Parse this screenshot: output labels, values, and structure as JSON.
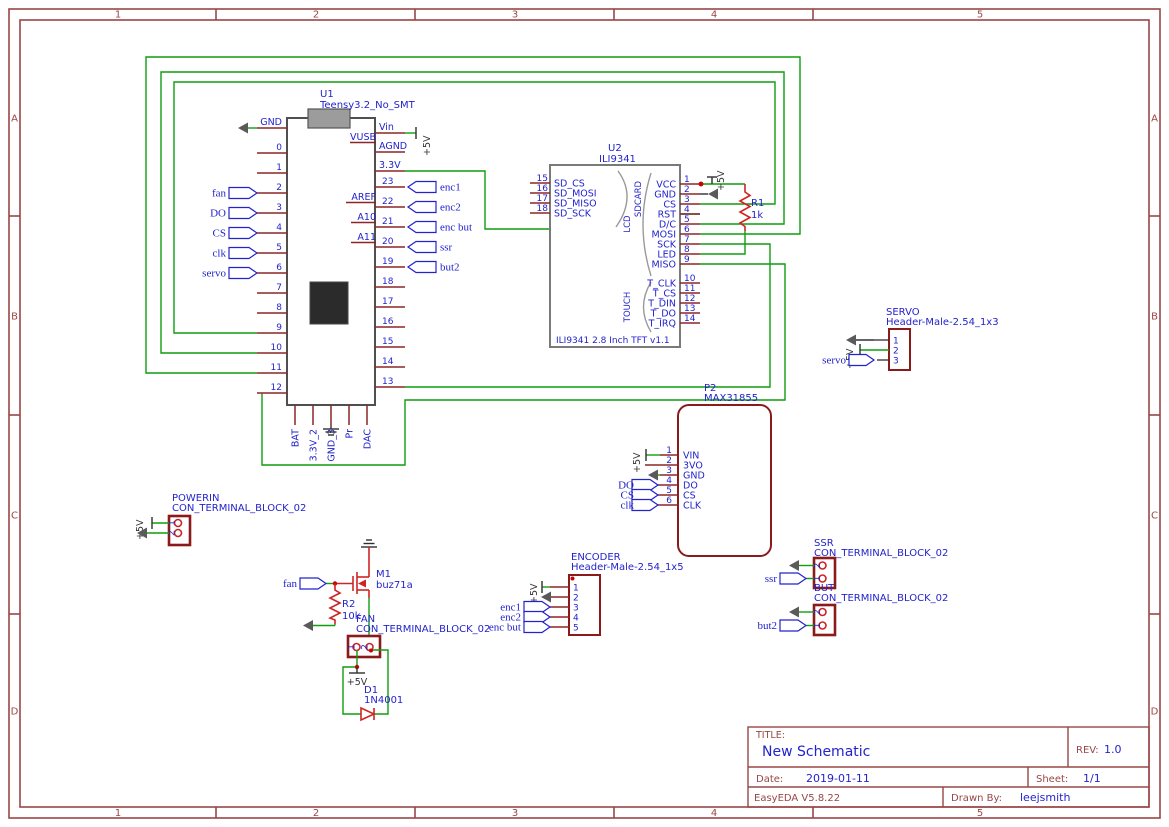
{
  "colors": {
    "wire": "#0f9e0f",
    "symbol": "#cf2424",
    "outline": "#8b1a1a",
    "pin": "#8c2626",
    "blue": "#2323cc",
    "frame": "#9a4646",
    "body_gray": "#7a7a7a",
    "body_dark": "#4f4f4f",
    "ground": "#5a5a5a",
    "junction": "#cc0000",
    "chip": "#2b2b2b",
    "usb": "#9c9c9c",
    "power_text": "#333333"
  },
  "frame": {
    "cols": [
      "1",
      "2",
      "3",
      "4",
      "5"
    ],
    "rows": [
      "A",
      "B",
      "C",
      "D"
    ]
  },
  "title_block": {
    "title_label": "TITLE:",
    "title": "New Schematic",
    "rev_label": "REV:",
    "rev": "1.0",
    "date_label": "Date:",
    "date": "2019-01-11",
    "sheet_label": "Sheet:",
    "sheet": "1/1",
    "tool": "EasyEDA V5.8.22",
    "drawn_by_label": "Drawn By:",
    "drawn_by": "leejsmith"
  },
  "power": {
    "p5": "+5V"
  },
  "u1": {
    "ref": "U1",
    "value": "Teensy3.2_No_SMT",
    "left_pins": [
      "GND",
      "0",
      "1",
      "2",
      "3",
      "4",
      "5",
      "6",
      "7",
      "8",
      "9",
      "10",
      "11",
      "12"
    ],
    "right_pins": [
      "Vin",
      "AGND",
      "3.3V",
      "23",
      "22",
      "21",
      "20",
      "19",
      "18",
      "17",
      "16",
      "15",
      "14",
      "13"
    ],
    "inner_pins": [
      "VUSB",
      "AREF",
      "A10",
      "A11"
    ],
    "bottom_pins": [
      "BAT",
      "3.3V_2",
      "GND_3",
      "Pr",
      "DAC"
    ],
    "left_flags": [
      "fan",
      "DO",
      "CS",
      "clk",
      "servo"
    ],
    "right_flags": [
      "enc1",
      "enc2",
      "enc but",
      "ssr",
      "but2"
    ]
  },
  "u2": {
    "ref": "U2",
    "value": "ILI9341",
    "note": "ILI9341 2.8 Inch TFT v1.1",
    "groups": [
      "SDCARD",
      "LCD",
      "TOUCH"
    ],
    "left_nums": [
      "15",
      "16",
      "17",
      "18"
    ],
    "left_names": [
      "SD_CS",
      "SD_MOSI",
      "SD_MISO",
      "SD_SCK"
    ],
    "right_nums": [
      "1",
      "2",
      "3",
      "4",
      "5",
      "6",
      "7",
      "8",
      "9",
      "10",
      "11",
      "12",
      "13",
      "14"
    ],
    "right_names": [
      "VCC",
      "GND",
      "CS",
      "RST",
      "D/C",
      "MOSI",
      "SCK",
      "LED",
      "MISO",
      "T_CLK",
      "T_CS",
      "T_DIN",
      "T_DO",
      "T_IRQ"
    ]
  },
  "p2": {
    "ref": "P2",
    "value": "MAX31855",
    "nums": [
      "1",
      "2",
      "3",
      "4",
      "5",
      "6"
    ],
    "names": [
      "VIN",
      "3VO",
      "GND",
      "DO",
      "CS",
      "CLK"
    ],
    "flags": [
      "DO",
      "CS",
      "clk"
    ]
  },
  "servo_conn": {
    "ref": "SERVO",
    "value": "Header-Male-2.54_1x3",
    "nums": [
      "1",
      "2",
      "3"
    ],
    "flag": "servo"
  },
  "encoder_conn": {
    "ref": "ENCODER",
    "value": "Header-Male-2.54_1x5",
    "nums": [
      "1",
      "2",
      "3",
      "4",
      "5"
    ],
    "flags": [
      "enc1",
      "enc2",
      "enc but"
    ]
  },
  "powerin_conn": {
    "ref": "POWERIN",
    "value": "CON_TERMINAL_BLOCK_02",
    "nums": [
      "1",
      "2"
    ]
  },
  "ssr_conn": {
    "ref": "SSR",
    "value": "CON_TERMINAL_BLOCK_02",
    "nums": [
      "2",
      "1"
    ],
    "flag": "ssr"
  },
  "but_conn": {
    "ref": "BUT",
    "value": "CON_TERMINAL_BLOCK_02",
    "nums": [
      "2",
      "1"
    ],
    "flag": "but2"
  },
  "fan_conn": {
    "ref": "FAN",
    "value": "CON_TERMINAL_BLOCK_02",
    "nums": [
      "1",
      "2"
    ]
  },
  "m1": {
    "ref": "M1",
    "value": "buz71a"
  },
  "r1": {
    "ref": "R1",
    "value": "1k"
  },
  "r2": {
    "ref": "R2",
    "value": "10k"
  },
  "d1": {
    "ref": "D1",
    "value": "1N4001"
  }
}
